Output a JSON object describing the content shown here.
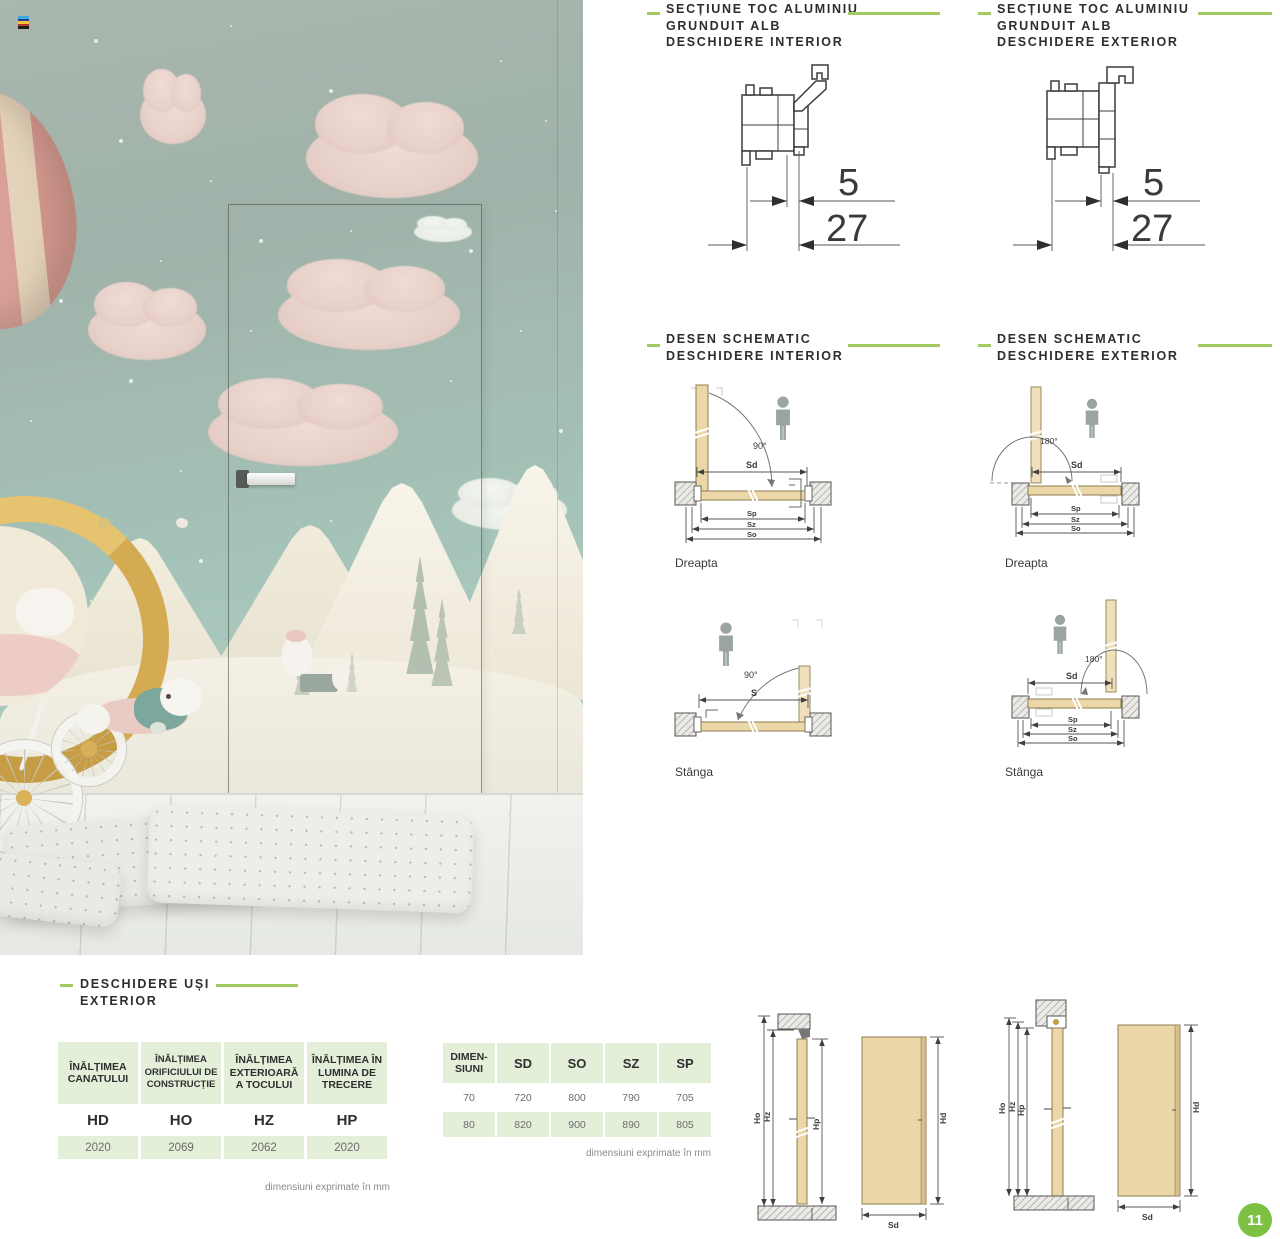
{
  "accent": {
    "green_line": "#a3c963",
    "page_green": "#7dc142",
    "table_green": "#e4efd9",
    "door_tan": "#ecd7a8"
  },
  "profile_sections": {
    "interior": {
      "lines": [
        "SECȚIUNE TOC ALUMINIU",
        "GRUNDUIT ALB",
        "DESCHIDERE INTERIOR"
      ],
      "dim_small": "5",
      "dim_large": "27"
    },
    "exterior": {
      "lines": [
        "SECȚIUNE TOC ALUMINIU",
        "GRUNDUIT ALB",
        "DESCHIDERE EXTERIOR"
      ],
      "dim_small": "5",
      "dim_large": "27"
    }
  },
  "schematic_sections": {
    "interior": {
      "lines": [
        "DESEN SCHEMATIC",
        "DESCHIDERE INTERIOR"
      ],
      "dreapta": {
        "label": "Dreapta",
        "angle": "90°",
        "dim_sd": "Sd",
        "dim_sp": "Sp",
        "dim_sz": "Sz",
        "dim_so": "So"
      },
      "stanga": {
        "label": "Stânga",
        "angle": "90°",
        "dim_s": "S"
      }
    },
    "exterior": {
      "lines": [
        "DESEN SCHEMATIC",
        "DESCHIDERE EXTERIOR"
      ],
      "dreapta": {
        "label": "Dreapta",
        "angle": "180°",
        "dim_sd": "Sd",
        "dim_sp": "Sp",
        "dim_sz": "Sz",
        "dim_so": "So"
      },
      "stanga": {
        "label": "Stânga",
        "angle": "180°",
        "dim_sd": "Sd",
        "dim_sp": "Sp",
        "dim_sz": "Sz",
        "dim_so": "So"
      }
    }
  },
  "opening_section": {
    "lines": [
      "DESCHIDERE UȘI",
      "EXTERIOR"
    ]
  },
  "height_table": {
    "columns": [
      {
        "header": "ÎNĂLȚIMEA CANATULUI",
        "code": "HD",
        "value": "2020"
      },
      {
        "header": "ÎNĂLȚIMEA ORIFICIULUI DE CONSTRUCȚIE",
        "code": "HO",
        "value": "2069"
      },
      {
        "header": "ÎNĂLȚIMEA EXTERIOARĂ A TOCULUI",
        "code": "HZ",
        "value": "2062"
      },
      {
        "header": "ÎNĂLȚIMEA ÎN LUMINA DE TRECERE",
        "code": "HP",
        "value": "2020"
      }
    ],
    "footnote": "dimensiuni exprimate în mm"
  },
  "width_table": {
    "headers": [
      "DIMEN-\nSIUNI",
      "SD",
      "SO",
      "SZ",
      "SP"
    ],
    "rows": [
      [
        "70",
        "720",
        "800",
        "790",
        "705"
      ],
      [
        "80",
        "820",
        "900",
        "890",
        "805"
      ]
    ],
    "footnote": "dimensiuni exprimate în mm"
  },
  "elevations": {
    "dim_ho": "Ho",
    "dim_hz": "Hz",
    "dim_hp": "Hp",
    "dim_hd": "Hd",
    "dim_sd": "Sd"
  },
  "page": {
    "number": "11"
  }
}
